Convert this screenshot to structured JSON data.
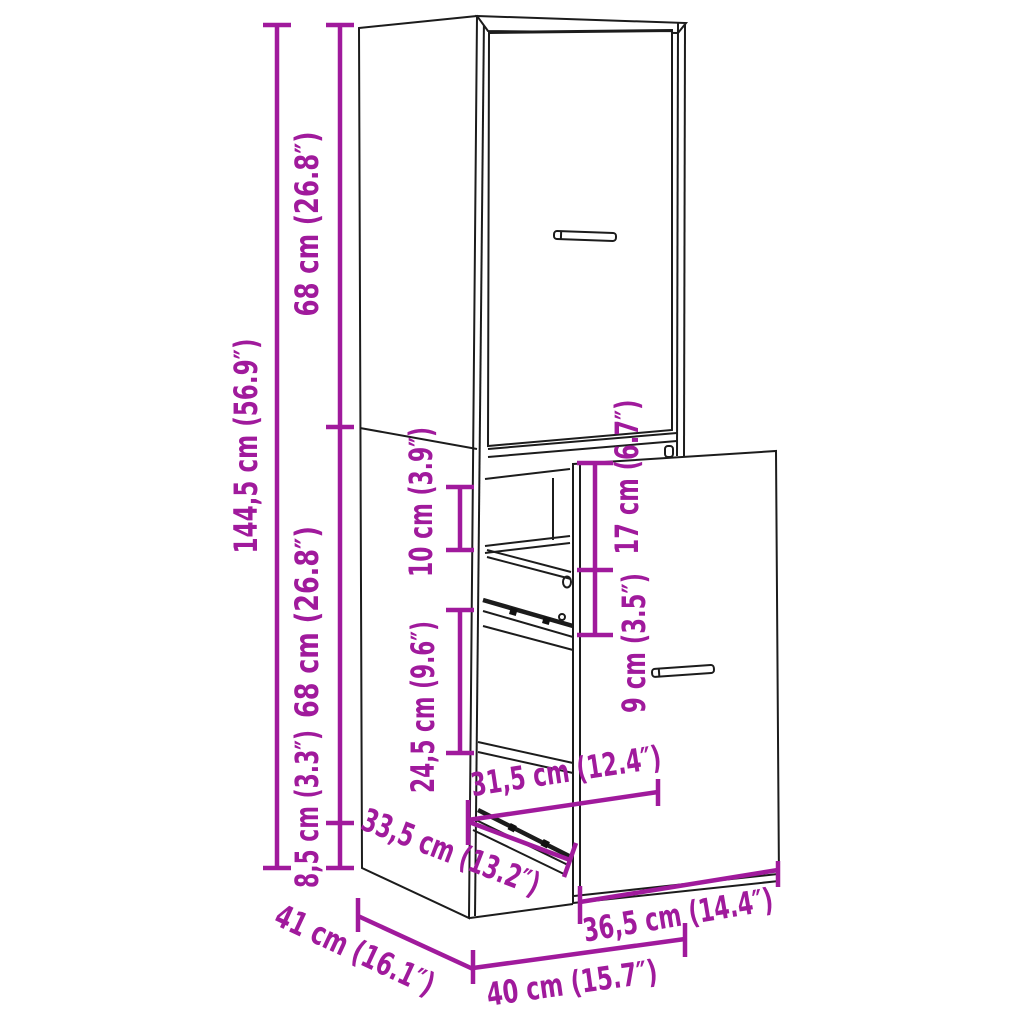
{
  "canvas": {
    "width": 1024,
    "height": 1024
  },
  "colors": {
    "dimension": "#a01a9c",
    "drawing": "#1c1c1c",
    "background": "#ffffff"
  },
  "figure": {
    "name": "tall-narrow-cabinet-with-pullout-drawer-line-drawing"
  },
  "dims": {
    "d144_5": {
      "label": "144,5 cm (56.9″)",
      "cm": "144,5",
      "inch": "56.9"
    },
    "d68_top": {
      "label": "68 cm (26.8″)",
      "cm": "68",
      "inch": "26.8"
    },
    "d68_mid": {
      "label": "68 cm (26.8″)",
      "cm": "68",
      "inch": "26.8"
    },
    "d8_5": {
      "label": "8,5 cm (3.3″)",
      "cm": "8,5",
      "inch": "3.3"
    },
    "d10": {
      "label": "10 cm (3.9″)",
      "cm": "10",
      "inch": "3.9"
    },
    "d24_5": {
      "label": "24,5 cm (9.6″)",
      "cm": "24,5",
      "inch": "9.6"
    },
    "d17": {
      "label": "17 cm (6.7″)",
      "cm": "17",
      "inch": "6.7"
    },
    "d9": {
      "label": "9 cm (3.5″)",
      "cm": "9",
      "inch": "3.5"
    },
    "d31_5": {
      "label": "31,5 cm (12.4″)",
      "cm": "31,5",
      "inch": "12.4"
    },
    "d33_5": {
      "label": "33,5 cm (13.2″)",
      "cm": "33,5",
      "inch": "13.2"
    },
    "d36_5": {
      "label": "36,5 cm (14.4″)",
      "cm": "36,5",
      "inch": "14.4"
    },
    "d40": {
      "label": "40 cm (15.7″)",
      "cm": "40",
      "inch": "15.7"
    },
    "d41": {
      "label": "41 cm (16.1″)",
      "cm": "41",
      "inch": "16.1"
    }
  }
}
